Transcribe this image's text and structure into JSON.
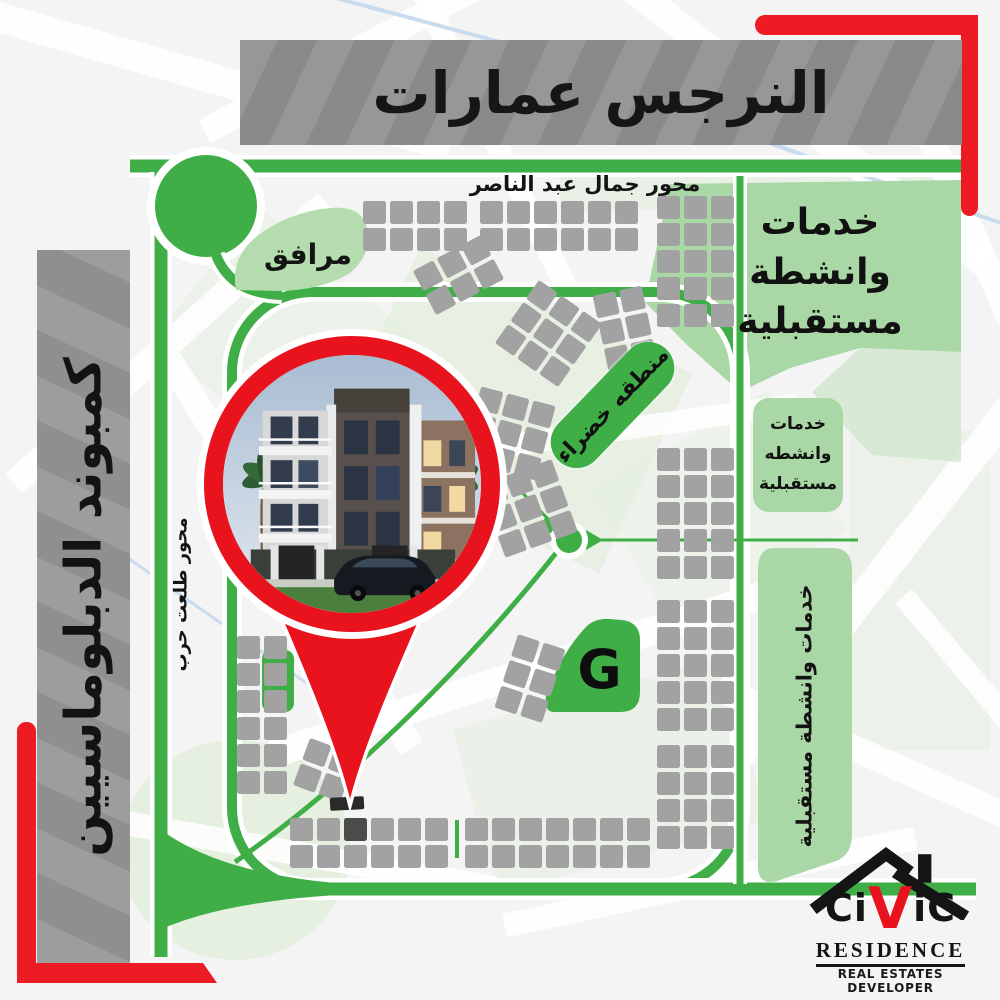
{
  "title": "النرجس عمارات",
  "streets": {
    "gamal_abdel_nasser_axis": "محور جمال عبد الناصر",
    "talaat_harb_axis": "محور طلعت حرب"
  },
  "sidebar": {
    "compound_label": "كمبوند الدبلوماسيين"
  },
  "map": {
    "facilities_label": "مرافق",
    "green_zone_label": "منطقه خضراء",
    "services_block_lines": {
      "l1": "خدمات",
      "l2": "وانشطة",
      "l3": "مستقبلية"
    },
    "services_box_lines": {
      "l1": "خدمات",
      "l2": "وانشطه",
      "l3": "مستقبلية"
    },
    "services_strip_label": "خدمات وانشطة مستقبلية",
    "g_plot_label": "G"
  },
  "logo": {
    "name_part1": "Ci",
    "name_part2": "V",
    "name_part3": "iC",
    "line2": "RESIDENCE",
    "line3": "REAL ESTATES DEVELOPER"
  },
  "colors": {
    "accent_red": "#ED1C24",
    "road_green": "#3FAE47",
    "light_green": "#A9D7A5",
    "banner_gray": "#8F8F8F"
  }
}
